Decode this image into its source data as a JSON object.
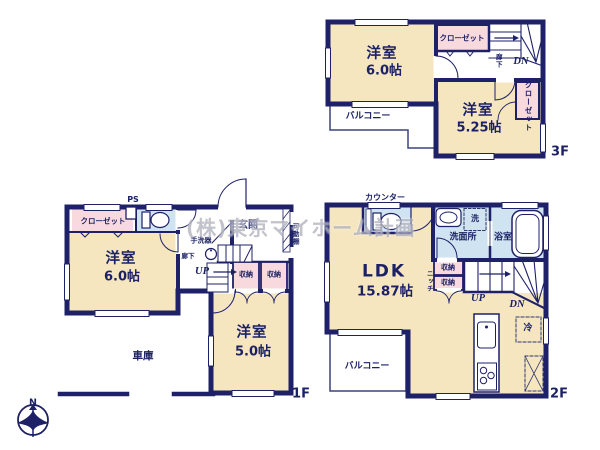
{
  "watermark": "(株)東京マイホーム計画",
  "compass": {
    "north_label": "N"
  },
  "floor3": {
    "floor_label": "3F",
    "bedroom_a_name": "洋室",
    "bedroom_a_size": "6.0帖",
    "bedroom_b_name": "洋室",
    "bedroom_b_size": "5.25帖",
    "closet_top": "クローゼット",
    "closet_side": "クローゼット",
    "hallway": "廊下",
    "stairs_down": "DN",
    "balcony": "バルコニー"
  },
  "floor2": {
    "floor_label": "2F",
    "ldk_name": "LDK",
    "ldk_size": "15.87帖",
    "counter": "カウンター",
    "washroom": "洗面所",
    "washer": "洗",
    "bathroom": "浴室",
    "storage_a": "収納",
    "storage_b": "収納",
    "niche": "ニッチ",
    "stairs_up": "UP",
    "stairs_down": "DN",
    "refrigerator": "冷",
    "balcony": "バルコニー"
  },
  "floor1": {
    "floor_label": "1F",
    "ps": "PS",
    "closet": "クローゼット",
    "bedroom_a_name": "洋室",
    "bedroom_a_size": "6.0帖",
    "bedroom_b_name": "洋室",
    "bedroom_b_size": "5.0帖",
    "hand_basin": "手洗器",
    "hallway": "廊下",
    "entrance": "玄関",
    "movable_shelf": "可動棚",
    "stairs_up": "UP",
    "storage_a": "収納",
    "storage_b": "収納",
    "garage": "車庫"
  }
}
